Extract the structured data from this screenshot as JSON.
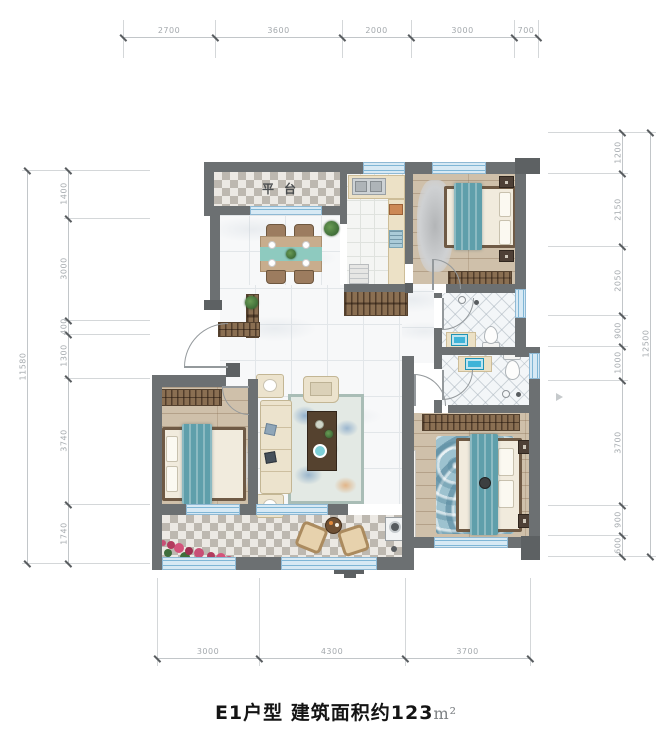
{
  "title": {
    "text": "E1户型 建筑面积约123",
    "unit": "m²"
  },
  "labels": {
    "platform": "平台"
  },
  "dimensions": {
    "top": [
      "2700",
      "3600",
      "2000",
      "3000",
      "700"
    ],
    "left": [
      "1400",
      "3000",
      "400",
      "1300",
      "3740",
      "1740"
    ],
    "left_total": "11580",
    "right": [
      "1200",
      "2150",
      "2050",
      "900",
      "1000",
      "3700",
      "900",
      "600"
    ],
    "right_total": "12500",
    "bottom": [
      "3000",
      "4300",
      "3700"
    ]
  },
  "colors": {
    "wall": "#6c7072",
    "window_blue": "#7fb6d6",
    "blanket_teal": "#5f9fab",
    "wood_floor": "#cfc0aa",
    "wardrobe_wood": "#8a6f52",
    "rug_blue": "#8fb9c8",
    "dining_runner": "#8ecabf",
    "sofa_cream": "#ece3cd",
    "flower_pink": "#c84f76",
    "dim_text": "#a4a9ad"
  }
}
